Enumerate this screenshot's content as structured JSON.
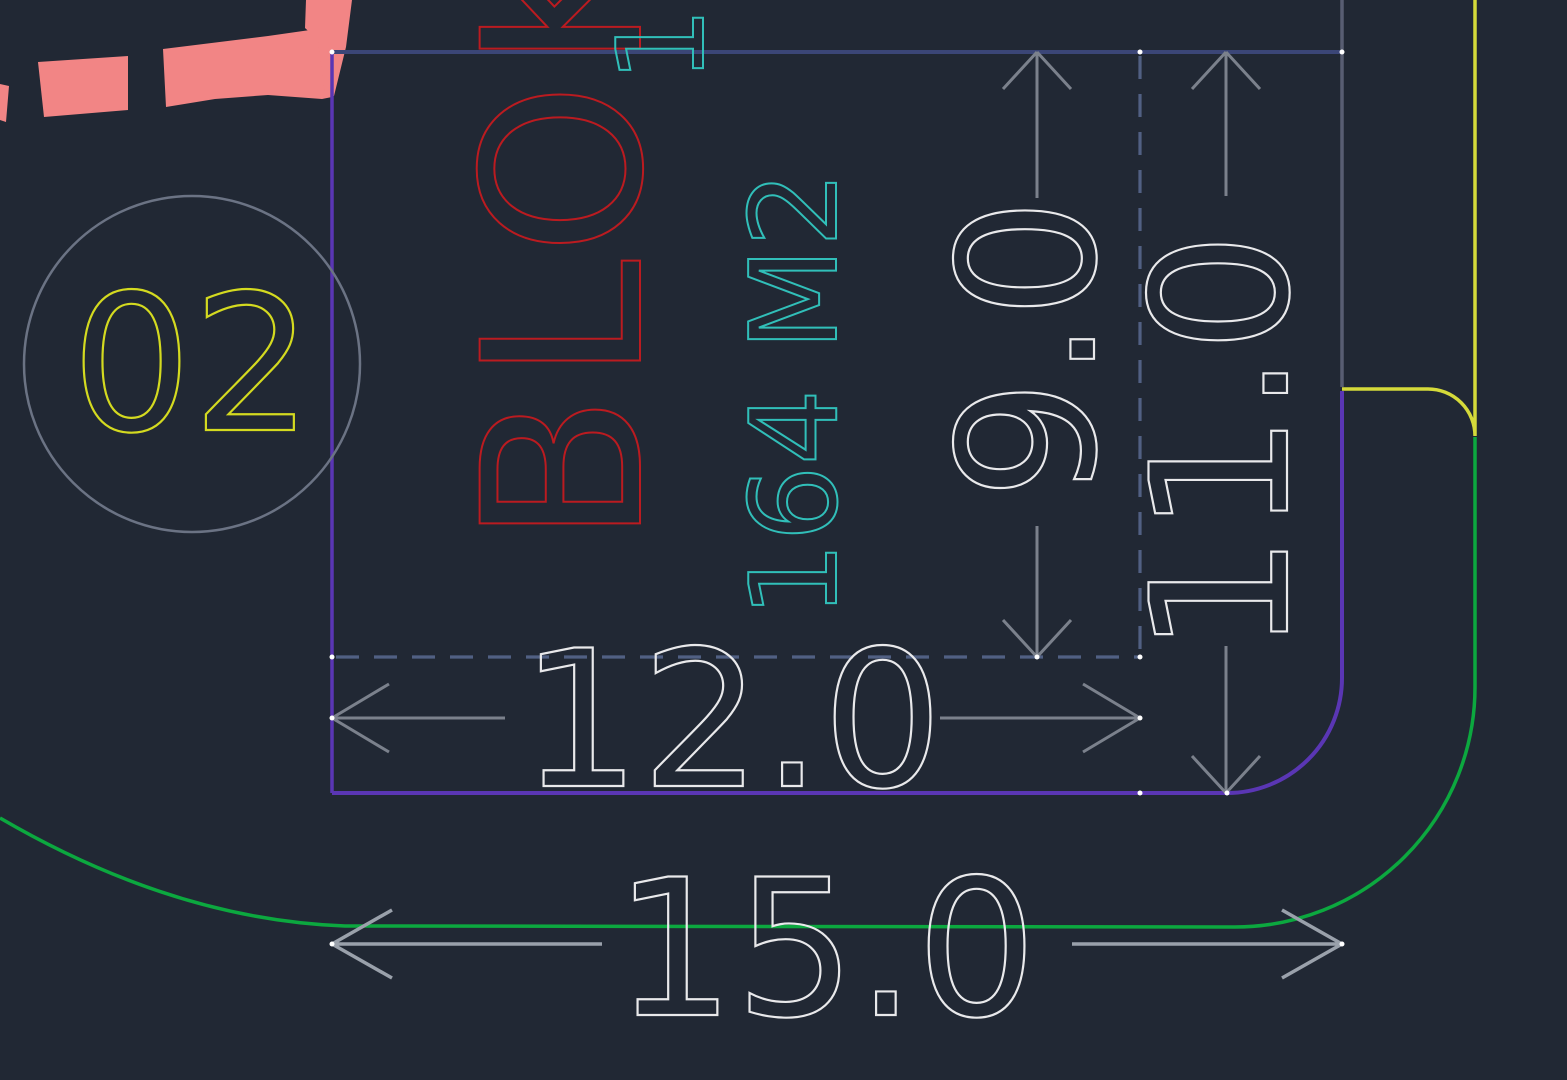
{
  "drawing": {
    "plot": {
      "number": "02",
      "block_label": "BLOK",
      "area_label": "164 M2"
    },
    "dimensions": {
      "inner_depth": "9.0",
      "side_depth": "11.0",
      "inner_width": "12.0",
      "frontage_width": "15.0"
    },
    "fragments": {
      "top_cyan_text": "1"
    },
    "colors": {
      "background": "#212834",
      "boundary_purple": "#5a36b4",
      "boundary_navy": "#3b4677",
      "boundary_gray": "#585d72",
      "road_edge_yellow": "#d5da3a",
      "road_edge_green": "#0ca83f",
      "road_marking_pink": "#f28585",
      "extension_dashed": "#516083",
      "dimension_gray": "#7b818c",
      "dimension_gray_light": "#9aa1ab",
      "text_white": "#e9e9eb",
      "text_red": "#bb1b20",
      "text_cyan": "#31bfb9",
      "text_yellow": "#d4da20",
      "circle_gray": "#6b7384",
      "vertex_white": "#ffffff"
    }
  }
}
